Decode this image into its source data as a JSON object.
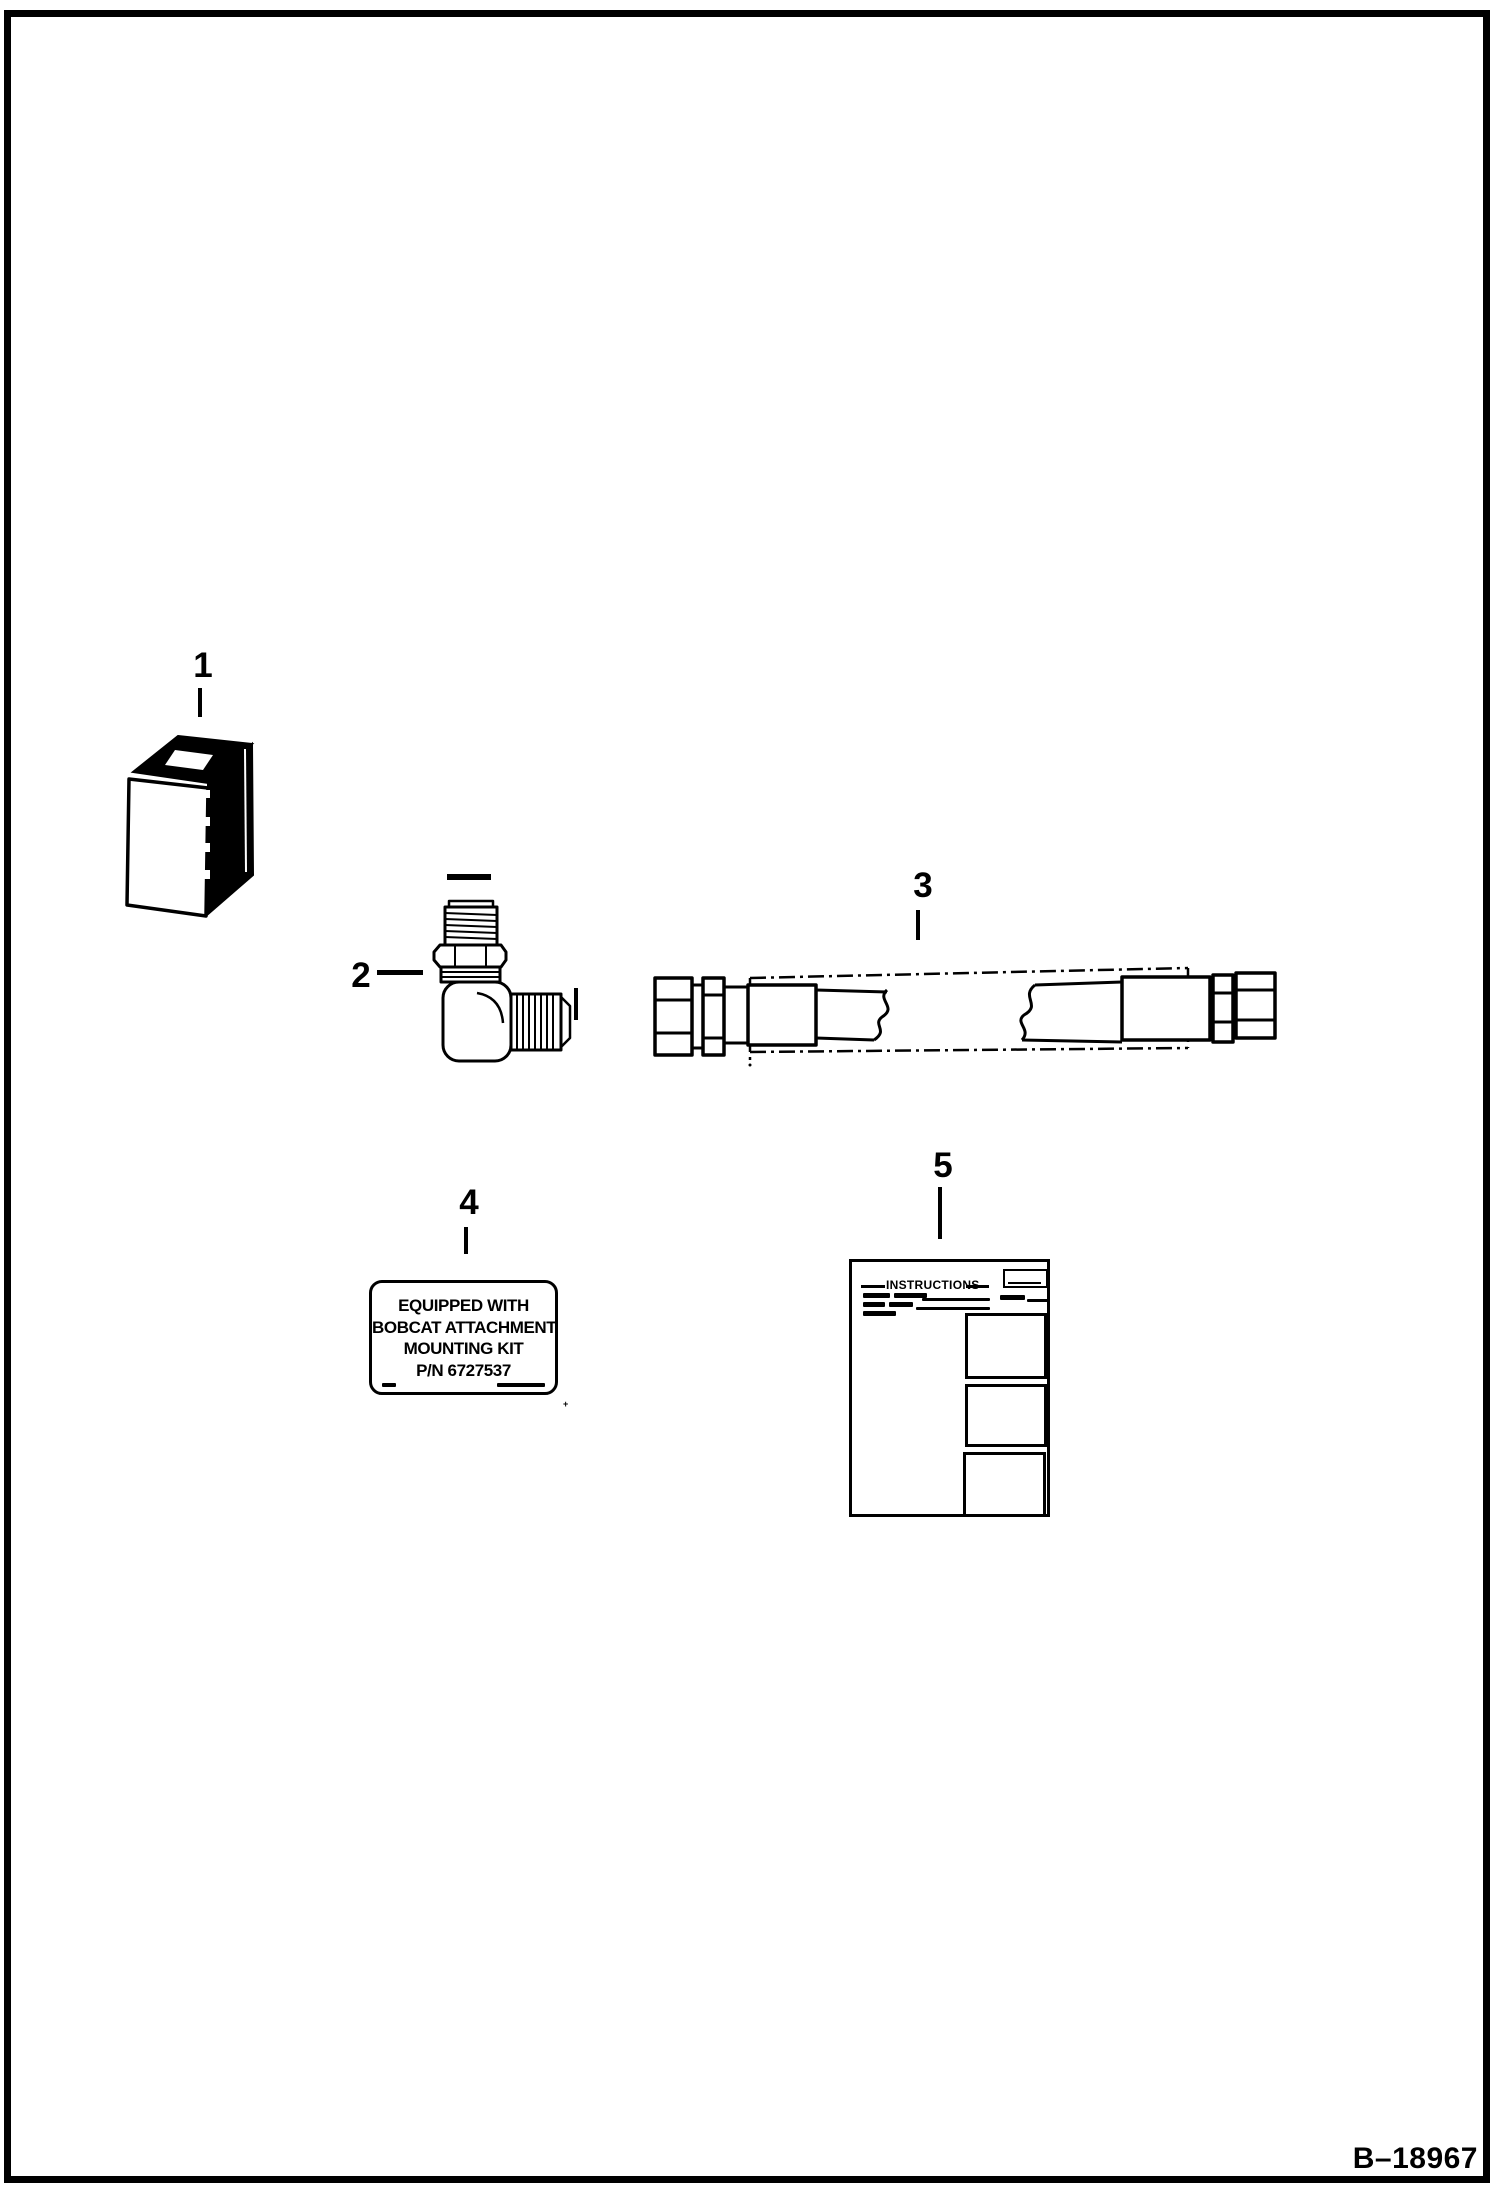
{
  "page": {
    "figure_code": "B–18967"
  },
  "callouts": {
    "c1": "1",
    "c2": "2",
    "c3": "3",
    "c4": "4",
    "c5": "5"
  },
  "decal": {
    "line1": "EQUIPPED WITH",
    "line2": "BOBCAT ATTACHMENT",
    "line3": "MOUNTING KIT",
    "line4": "P/N 6727537"
  },
  "instruction_sheet": {
    "title": "INSTRUCTIONS"
  },
  "colors": {
    "ink": "#000000",
    "paper": "#ffffff"
  }
}
